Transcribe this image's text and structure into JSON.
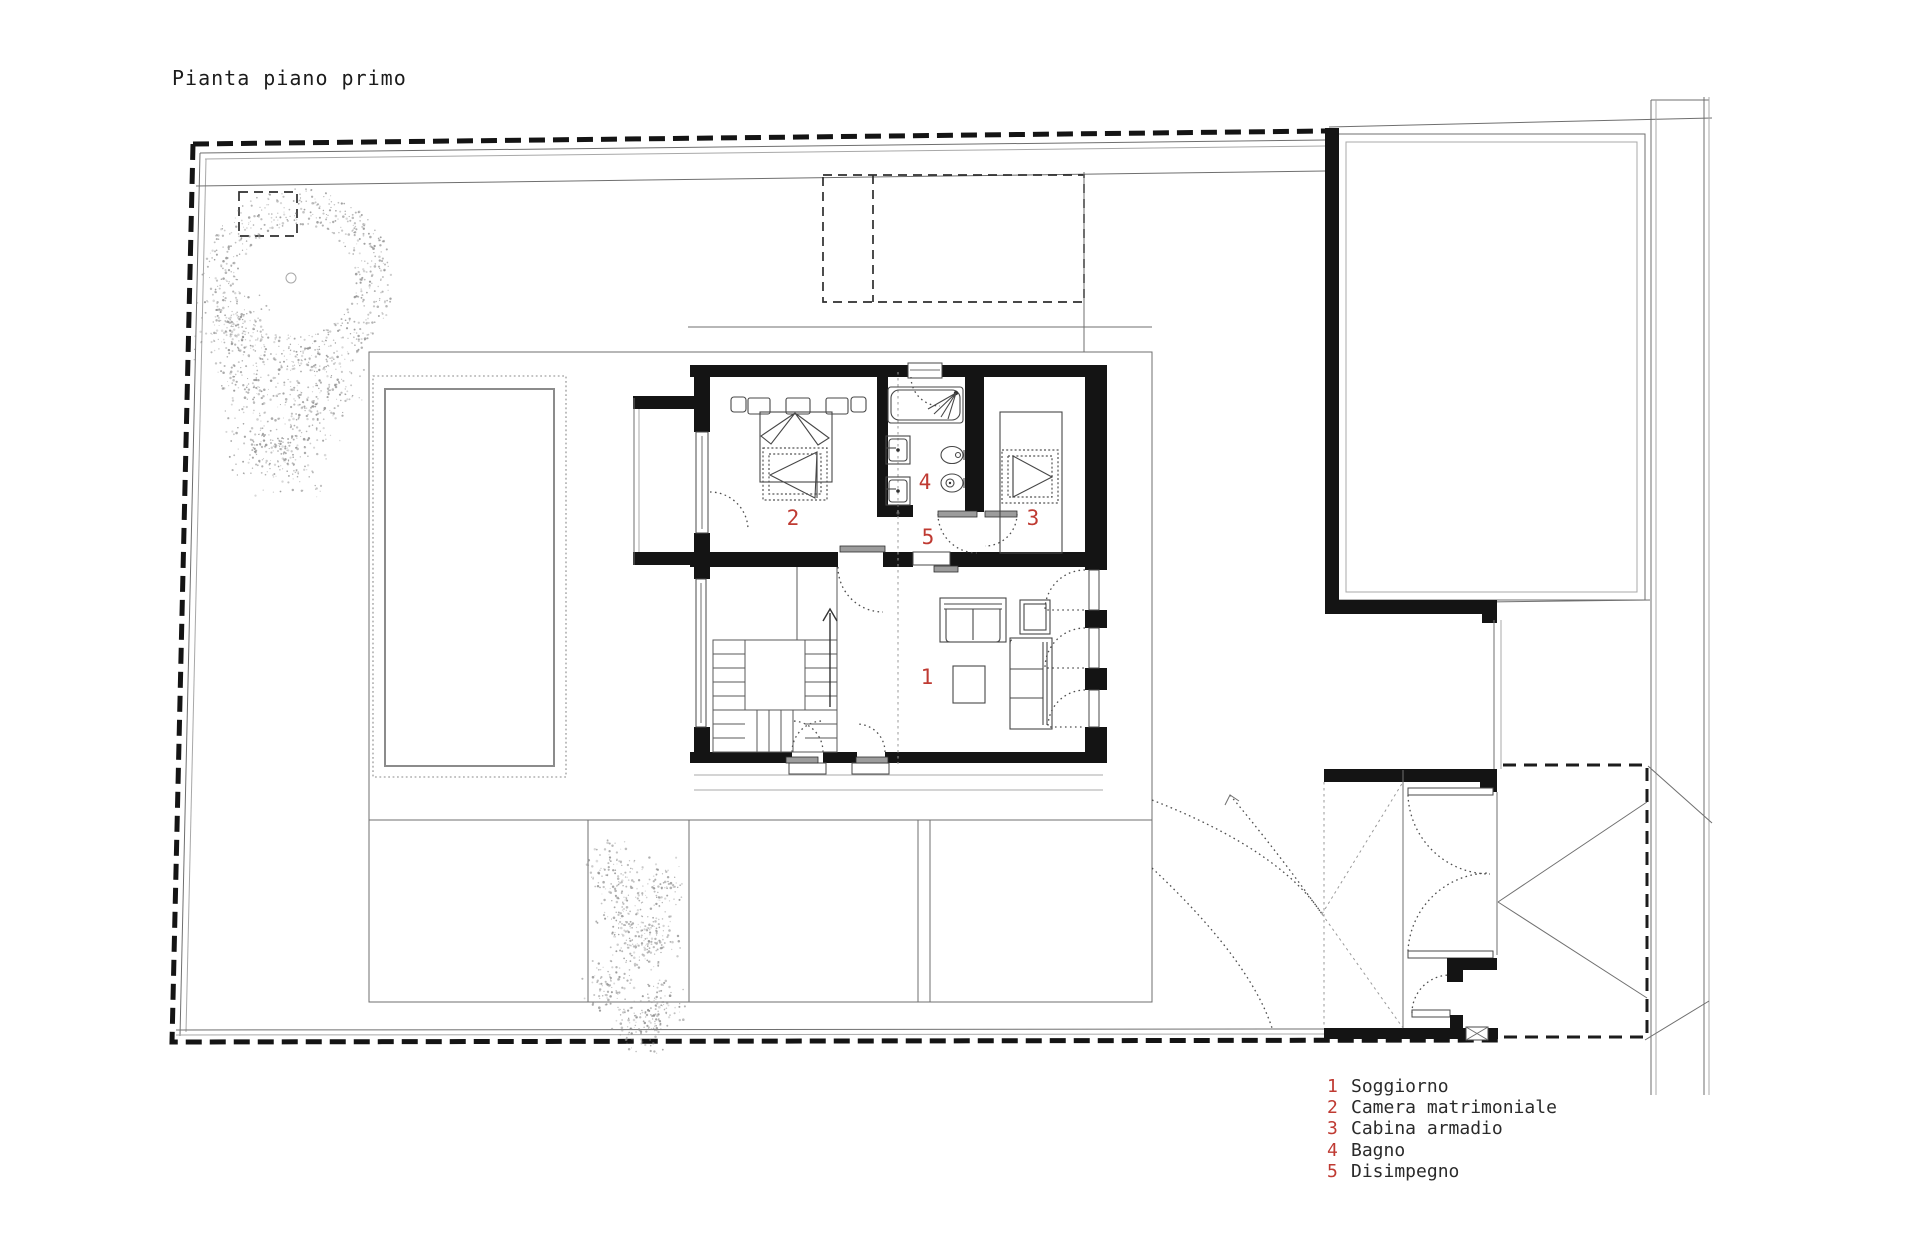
{
  "title": "Pianta piano primo",
  "colors": {
    "accent": "#bf3a32",
    "ink": "#1b1b1b",
    "wall": "#141414"
  },
  "legend": {
    "items": [
      {
        "number": "1",
        "label": "Soggiorno"
      },
      {
        "number": "2",
        "label": "Camera matrimoniale"
      },
      {
        "number": "3",
        "label": "Cabina armadio"
      },
      {
        "number": "4",
        "label": "Bagno"
      },
      {
        "number": "5",
        "label": "Disimpegno"
      }
    ]
  },
  "plan": {
    "room_markers": [
      {
        "number": "1",
        "room": "soggiorno"
      },
      {
        "number": "2",
        "room": "camera-matrimoniale"
      },
      {
        "number": "3",
        "room": "cabina-armadio"
      },
      {
        "number": "4",
        "room": "bagno"
      },
      {
        "number": "5",
        "room": "disimpegno"
      }
    ]
  }
}
